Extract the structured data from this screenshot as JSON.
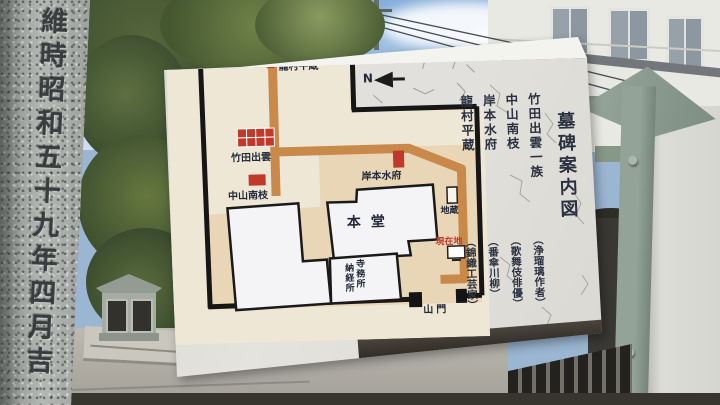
{
  "pillar": {
    "inscription": "維時昭和五十九年四月吉"
  },
  "sign": {
    "title": "墓碑案内図",
    "legend": [
      {
        "name": "竹田出雲一族",
        "desc": "（浄瑠璃作者）"
      },
      {
        "name": "中山南枝",
        "desc": "（歌舞伎俳優）"
      },
      {
        "name": "岸本水府",
        "desc": "（番傘川柳）"
      },
      {
        "name": "龍村平蔵",
        "desc": "（錦織工芸家）"
      }
    ],
    "map": {
      "compass": "N",
      "labels": {
        "tatsumura": "龍村平蔵",
        "takeda": "竹田出雲",
        "nakayama": "中山南枝",
        "kishimoto": "岸本水府",
        "jizo": "地蔵",
        "hondo": "本堂",
        "office_right": "寺務所",
        "office_left": "納経所",
        "genzaichi": "現在地",
        "sanmon": "山門"
      },
      "colors": {
        "path": "#c9894a",
        "courtyard": "#e8d6b6",
        "marker": "#c0392b",
        "wall": "#161616",
        "cream": "#efe7d6",
        "stone": "#e1e0dc"
      }
    }
  }
}
